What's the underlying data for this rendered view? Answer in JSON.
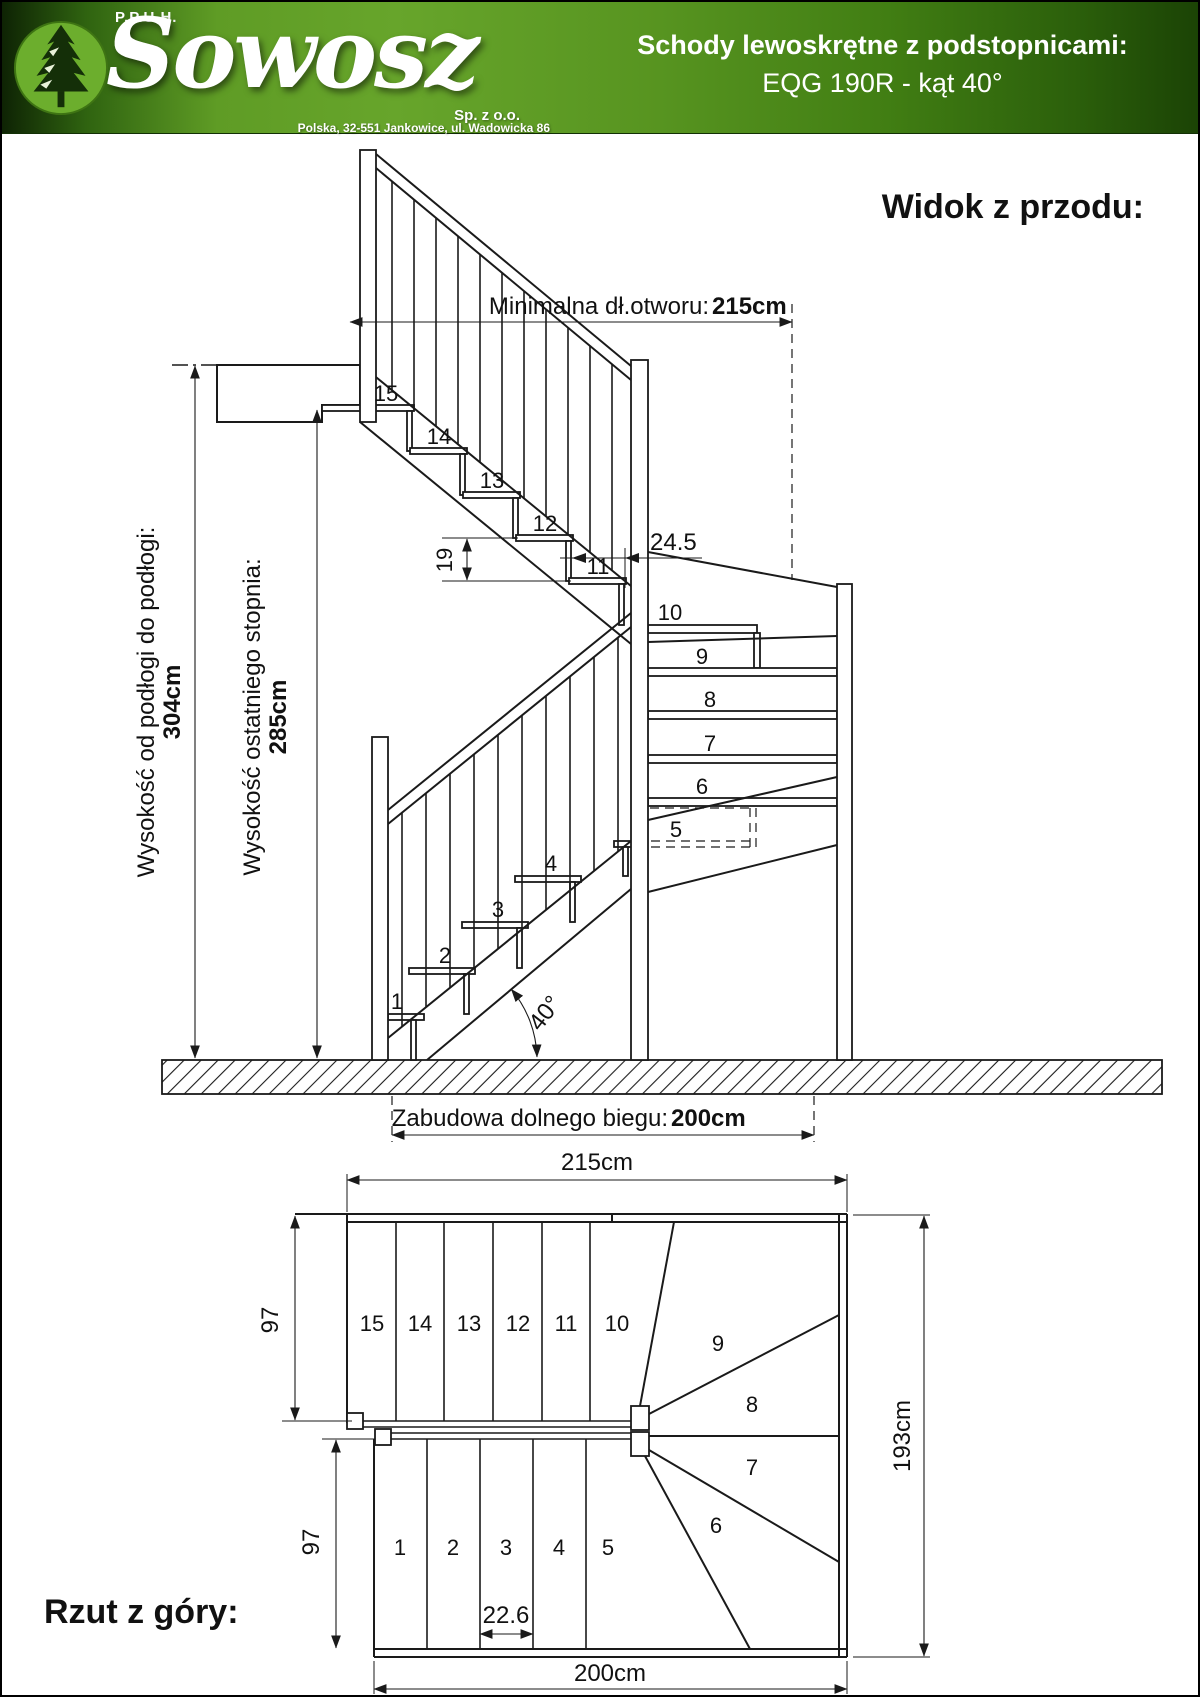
{
  "header": {
    "company_prefix": "P.P.U.H.",
    "company_name": "Sowosz",
    "company_suffix": "Sp. z o.o.",
    "address": "Polska, 32-551 Jankowice, ul. Wadowicka 86",
    "product_title": "Schody lewoskrętne z podstopnicami:",
    "product_subtitle": "EQG 190R - kąt 40°",
    "colors": {
      "banner_green": "#5f9c25",
      "logo_circle": "#6cae2d",
      "logo_tree": "#142f08",
      "text": "#ffffff"
    }
  },
  "front_view": {
    "title": "Widok z przodu:",
    "dims": {
      "min_opening_label": "Minimalna dł.otworu: ",
      "min_opening_value": "215cm",
      "floor_to_floor_label": "Wysokość od podłogi do podłogi:",
      "floor_to_floor_value": "304cm",
      "last_step_label": "Wysokość ostatniego stopnia:",
      "last_step_value": "285cm",
      "lower_run_label": "Zabudowa dolnego biegu: ",
      "lower_run_value": "200cm",
      "riser_height": "19",
      "tread_depth": "24.5",
      "angle": "40°"
    }
  },
  "top_view": {
    "title": "Rzut z góry:",
    "dims": {
      "width": "215cm",
      "depth": "193cm",
      "bottom_width": "200cm",
      "upper_flight_depth": "97",
      "lower_flight_depth": "97",
      "tread_width": "22.6"
    }
  },
  "steps": {
    "s1": "1",
    "s2": "2",
    "s3": "3",
    "s4": "4",
    "s5": "5",
    "s6": "6",
    "s7": "7",
    "s8": "8",
    "s9": "9",
    "s10": "10",
    "s11": "11",
    "s12": "12",
    "s13": "13",
    "s14": "14",
    "s15": "15"
  }
}
